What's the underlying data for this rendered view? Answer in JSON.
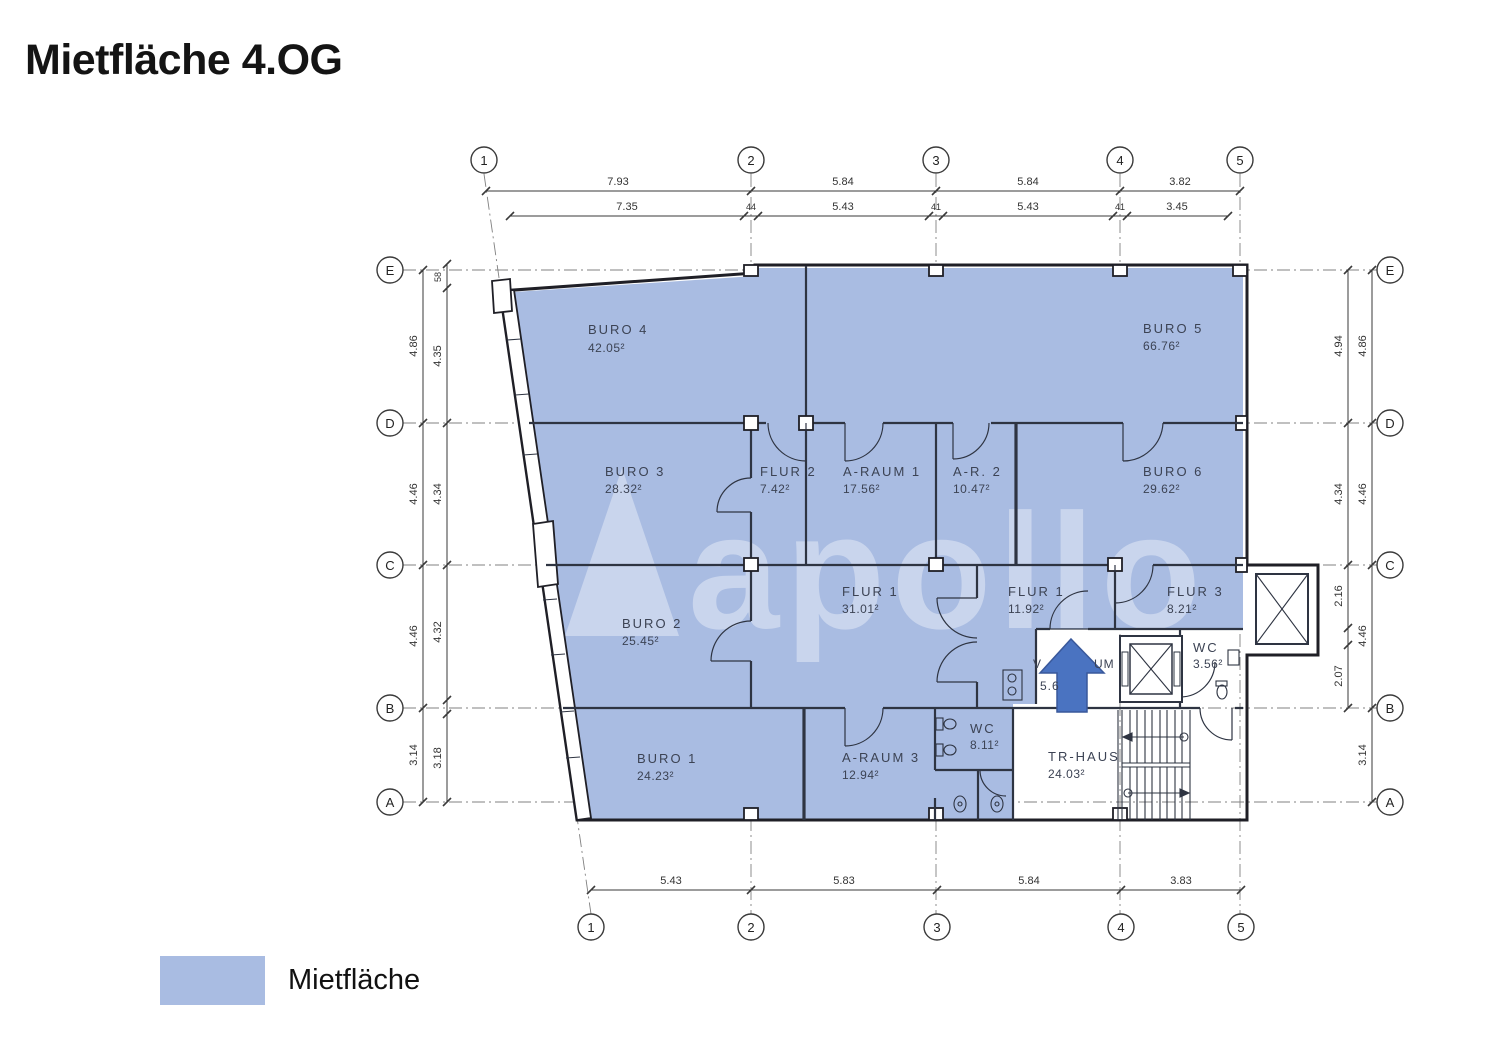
{
  "title": "Mietfläche 4.OG",
  "legend": {
    "label": "Mietfläche",
    "swatch_color": "#a9bce2"
  },
  "watermark": "apollo",
  "axes": {
    "cols": [
      "1",
      "2",
      "3",
      "4",
      "5"
    ],
    "rows": [
      "E",
      "D",
      "C",
      "B",
      "A"
    ]
  },
  "dims": {
    "top1": [
      "7.93",
      "5.84",
      "5.84",
      "3.82"
    ],
    "top2": [
      "7.35",
      "44",
      "5.43",
      "41",
      "5.43",
      "41",
      "3.45"
    ],
    "bottom": [
      "5.43",
      "5.83",
      "5.84",
      "3.83"
    ],
    "left_outer": [
      "4.86",
      "4.46",
      "4.46",
      "3.14"
    ],
    "left_inner": [
      "58",
      "4.35",
      "4.34",
      "4.32",
      "3.18"
    ],
    "right_inner": [
      "4.94",
      "4.34",
      "2.16",
      "2.07"
    ],
    "right_outer": [
      "4.86",
      "4.46",
      "4.46",
      "3.14"
    ]
  },
  "rooms": [
    {
      "name": "BURO 4",
      "area": "42.05²"
    },
    {
      "name": "BURO 5",
      "area": "66.76²"
    },
    {
      "name": "BURO 3",
      "area": "28.32²"
    },
    {
      "name": "FLUR 2",
      "area": "7.42²"
    },
    {
      "name": "A-RAUM 1",
      "area": "17.56²"
    },
    {
      "name": "A-R. 2",
      "area": "10.47²"
    },
    {
      "name": "BURO 6",
      "area": "29.62²"
    },
    {
      "name": "BURO 2",
      "area": "25.45²"
    },
    {
      "name": "FLUR 1",
      "area": "31.01²"
    },
    {
      "name": "FLUR 1",
      "area": "11.92²"
    },
    {
      "name": "FLUR 3",
      "area": "8.21²"
    },
    {
      "name": "WC",
      "area": "3.56²"
    },
    {
      "name": "BURO 1",
      "area": "24.23²"
    },
    {
      "name": "A-RAUM 3",
      "area": "12.94²"
    },
    {
      "name": "WC",
      "area": "8.11²"
    },
    {
      "name": "TR-HAUS",
      "area": "24.03²"
    }
  ],
  "fragments": {
    "left": "V",
    "right": "UM",
    "num": "5.6"
  },
  "colors": {
    "mietflaeche": "#a9bce2",
    "arrow": "#4a73c1"
  }
}
